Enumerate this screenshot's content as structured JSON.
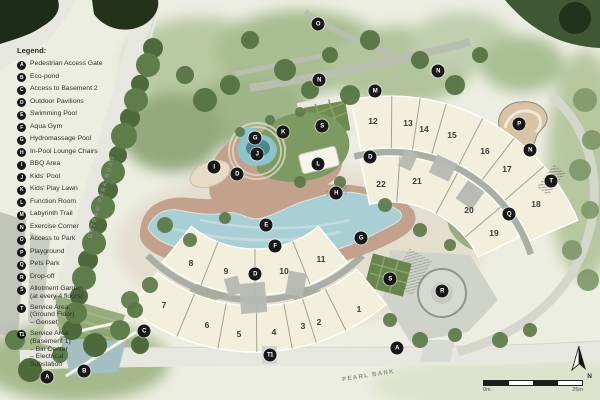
{
  "theme": {
    "badge-bg": "#181818",
    "badge-text": "#ffffff",
    "building": "#f3efdd",
    "pool": "#a9ced3",
    "lawn": "#7d9a62",
    "deck": "#c2a28d",
    "road": "#e6e7de",
    "ink": "#2d2d2b"
  },
  "legend": {
    "title": "Legend:",
    "items": [
      {
        "letter": "A",
        "label": "Pedestrian Access Gate"
      },
      {
        "letter": "B",
        "label": "Eco-pond"
      },
      {
        "letter": "C",
        "label": "Access to Basement 2"
      },
      {
        "letter": "D",
        "label": "Outdoor Pavilions"
      },
      {
        "letter": "E",
        "label": "Swimming Pool"
      },
      {
        "letter": "F",
        "label": "Aqua Gym"
      },
      {
        "letter": "G",
        "label": "Hydromassage Pool"
      },
      {
        "letter": "H",
        "label": "In-Pool Lounge Chairs"
      },
      {
        "letter": "I",
        "label": "BBQ Area"
      },
      {
        "letter": "J",
        "label": "Kids' Pool"
      },
      {
        "letter": "K",
        "label": "Kids' Play Lawn"
      },
      {
        "letter": "L",
        "label": "Function Room"
      },
      {
        "letter": "M",
        "label": "Labyrinth Trail"
      },
      {
        "letter": "N",
        "label": "Exercise Corner"
      },
      {
        "letter": "O",
        "label": "Access to Park"
      },
      {
        "letter": "P",
        "label": "Playground"
      },
      {
        "letter": "Q",
        "label": "Pets Park"
      },
      {
        "letter": "R",
        "label": "Drop-off"
      },
      {
        "letter": "S",
        "label": "Allotment Garden\n(at every 4 floors)"
      },
      {
        "letter": "T",
        "label": "Service Area\n(Ground Floor)\n– Genset"
      },
      {
        "letter": "T1",
        "label": "Service Area\n(Basement 1)\n– Bin Center\n– Electrical\n   Substation"
      }
    ]
  },
  "map": {
    "badges": [
      {
        "letter": "O",
        "x": 318,
        "y": 24
      },
      {
        "letter": "N",
        "x": 319,
        "y": 80
      },
      {
        "letter": "M",
        "x": 375,
        "y": 91
      },
      {
        "letter": "N",
        "x": 438,
        "y": 71
      },
      {
        "letter": "K",
        "x": 283,
        "y": 132
      },
      {
        "letter": "S",
        "x": 322,
        "y": 126
      },
      {
        "letter": "G",
        "x": 255,
        "y": 138
      },
      {
        "letter": "J",
        "x": 257,
        "y": 154
      },
      {
        "letter": "I",
        "x": 214,
        "y": 167
      },
      {
        "letter": "D",
        "x": 237,
        "y": 174
      },
      {
        "letter": "L",
        "x": 318,
        "y": 164
      },
      {
        "letter": "H",
        "x": 336,
        "y": 193
      },
      {
        "letter": "P",
        "x": 519,
        "y": 124
      },
      {
        "letter": "N",
        "x": 530,
        "y": 150
      },
      {
        "letter": "T",
        "x": 551,
        "y": 181
      },
      {
        "letter": "D",
        "x": 370,
        "y": 157
      },
      {
        "letter": "Q",
        "x": 509,
        "y": 214
      },
      {
        "letter": "E",
        "x": 266,
        "y": 225
      },
      {
        "letter": "F",
        "x": 275,
        "y": 246
      },
      {
        "letter": "D",
        "x": 255,
        "y": 274
      },
      {
        "letter": "G",
        "x": 361,
        "y": 238
      },
      {
        "letter": "C",
        "x": 144,
        "y": 331
      },
      {
        "letter": "S",
        "x": 390,
        "y": 279
      },
      {
        "letter": "R",
        "x": 442,
        "y": 291
      },
      {
        "letter": "A",
        "x": 397,
        "y": 348
      },
      {
        "letter": "A",
        "x": 47,
        "y": 377
      },
      {
        "letter": "B",
        "x": 84,
        "y": 371
      },
      {
        "letter": "T1",
        "x": 270,
        "y": 355
      }
    ],
    "buildings": [
      {
        "num": "12",
        "x": 373,
        "y": 121
      },
      {
        "num": "13",
        "x": 408,
        "y": 123
      },
      {
        "num": "14",
        "x": 424,
        "y": 129
      },
      {
        "num": "15",
        "x": 452,
        "y": 135
      },
      {
        "num": "16",
        "x": 485,
        "y": 151
      },
      {
        "num": "17",
        "x": 507,
        "y": 169
      },
      {
        "num": "18",
        "x": 536,
        "y": 204
      },
      {
        "num": "22",
        "x": 381,
        "y": 184
      },
      {
        "num": "21",
        "x": 417,
        "y": 181
      },
      {
        "num": "20",
        "x": 469,
        "y": 210
      },
      {
        "num": "19",
        "x": 494,
        "y": 233
      },
      {
        "num": "8",
        "x": 191,
        "y": 263
      },
      {
        "num": "9",
        "x": 226,
        "y": 271
      },
      {
        "num": "10",
        "x": 284,
        "y": 271
      },
      {
        "num": "11",
        "x": 321,
        "y": 259
      },
      {
        "num": "7",
        "x": 164,
        "y": 305
      },
      {
        "num": "6",
        "x": 207,
        "y": 325
      },
      {
        "num": "5",
        "x": 239,
        "y": 334
      },
      {
        "num": "4",
        "x": 274,
        "y": 332
      },
      {
        "num": "3",
        "x": 303,
        "y": 326
      },
      {
        "num": "2",
        "x": 319,
        "y": 322
      },
      {
        "num": "1",
        "x": 359,
        "y": 309
      }
    ],
    "roads": {
      "outram": "OUTRAM PARK ROAD",
      "pearl": "PEARL BANK"
    },
    "scale": {
      "start": "0m",
      "end": "25m"
    },
    "north_label": "N"
  }
}
